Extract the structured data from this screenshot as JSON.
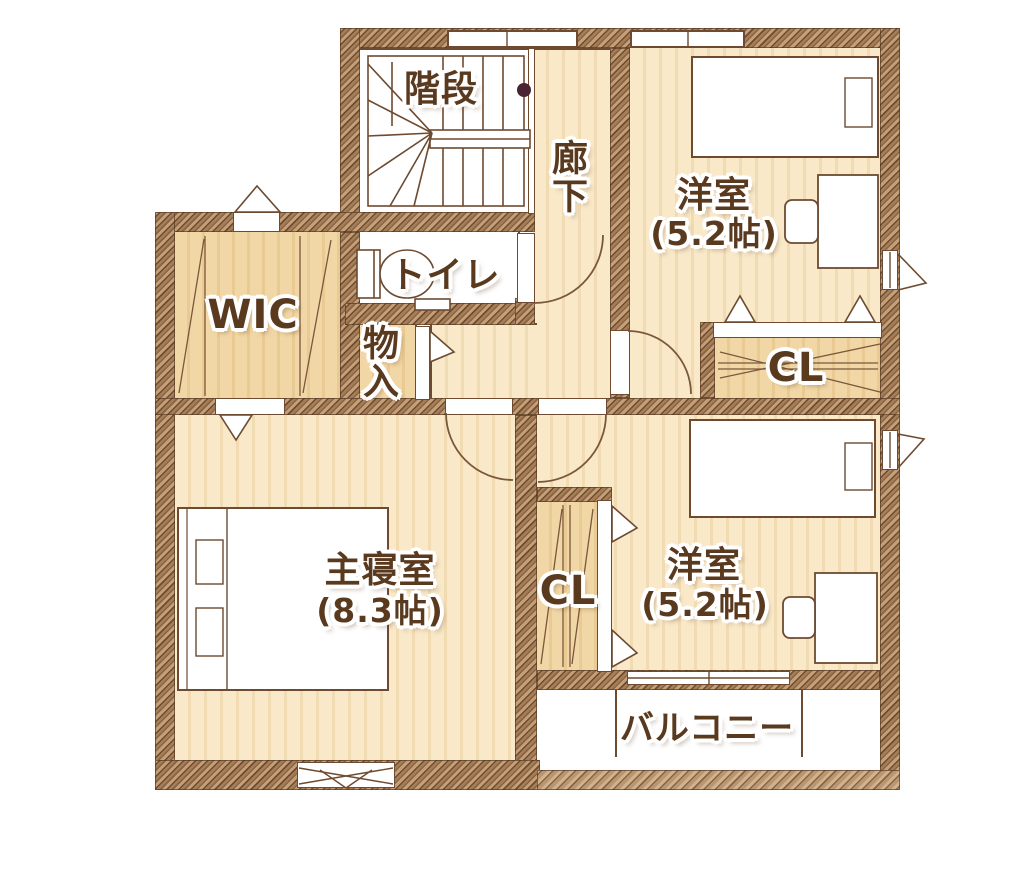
{
  "plan": {
    "rooms": [
      {
        "id": "stairs",
        "label": "階段"
      },
      {
        "id": "hallway",
        "label": "廊下"
      },
      {
        "id": "bedroom_north",
        "label": "洋室",
        "area": "(5.2帖)"
      },
      {
        "id": "closet_north",
        "label": "CL"
      },
      {
        "id": "toilet",
        "label": "トイレ"
      },
      {
        "id": "wic",
        "label": "WIC"
      },
      {
        "id": "storage",
        "label": "物入"
      },
      {
        "id": "master_bedroom",
        "label": "主寝室",
        "area": "(8.3帖)"
      },
      {
        "id": "closet_south",
        "label": "CL"
      },
      {
        "id": "bedroom_south",
        "label": "洋室",
        "area": "(5.2帖)"
      },
      {
        "id": "balcony",
        "label": "バルコニー"
      }
    ],
    "colors": {
      "background": "#ffffff",
      "wall_fill": "#a57e58",
      "wall_stroke": "#6f4c31",
      "drawing_line": "#6d4a30",
      "floor_cream": "#f9e9c9",
      "floor_cream_stripe": "#f1dbb3",
      "floor_tan": "#f2d7a6",
      "floor_tan_stripe": "#e9ca92",
      "label_text": "#5a3a1e",
      "label_halo": "#ffffff",
      "stair_dot": "#4a2433"
    }
  }
}
